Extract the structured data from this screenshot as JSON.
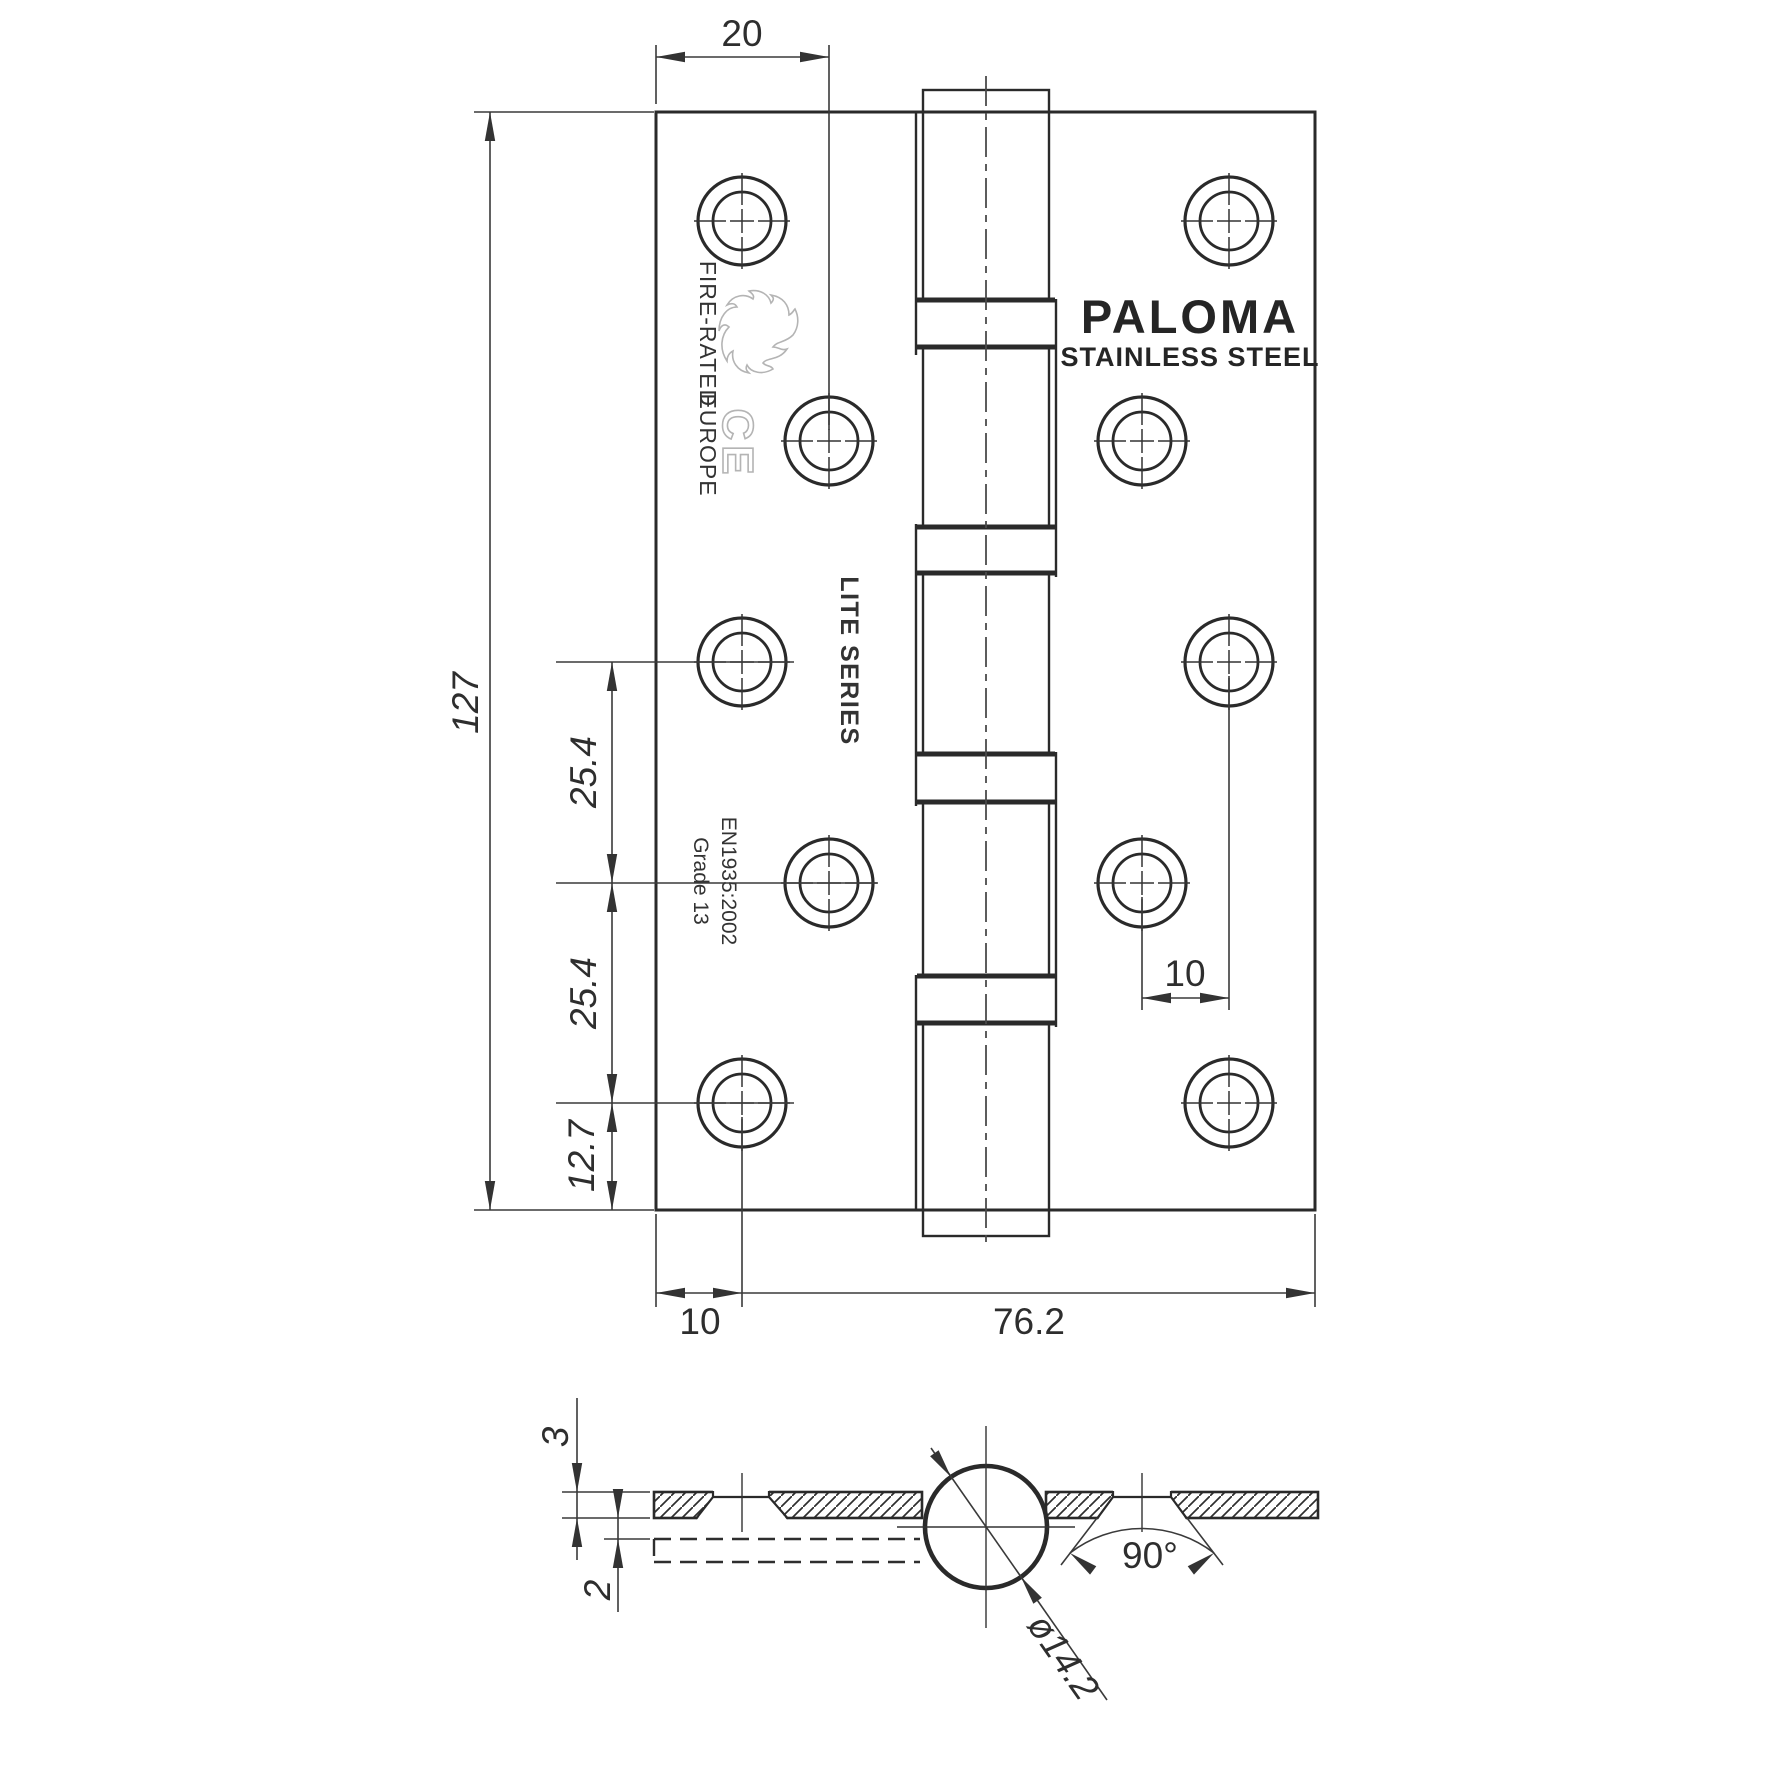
{
  "title": "Stainless steel door hinge technical drawing",
  "brand": {
    "logo": "PALOMA",
    "subtitle": "STAINLESS STEEL"
  },
  "markings": {
    "fire_rated": "FIRE-RATED",
    "europe": "EUROPE",
    "ce_mark": "CE",
    "series": "LITE SERIES",
    "standard": "EN1935:2002",
    "grade": "Grade 13"
  },
  "dims": {
    "top_hole_offset": "20",
    "leaf_height": "127",
    "pitch_a": "25.4",
    "pitch_b": "25.4",
    "bottom_hole_offset": "12.7",
    "edge_hole_offset": "10",
    "open_width": "76.2",
    "hole_stagger": "10",
    "leaf_thickness": "3",
    "leaf_gap": "2",
    "countersink_angle": "90°",
    "knuckle_diameter": "ø14.2"
  },
  "icons": {
    "flame": "flame-outline-icon",
    "ce": "ce-mark-icon"
  },
  "colors": {
    "outline": "#2a2a2a",
    "dimension": "#3a3a3a",
    "light_mark": "#b4b4b4",
    "background": "#ffffff"
  }
}
